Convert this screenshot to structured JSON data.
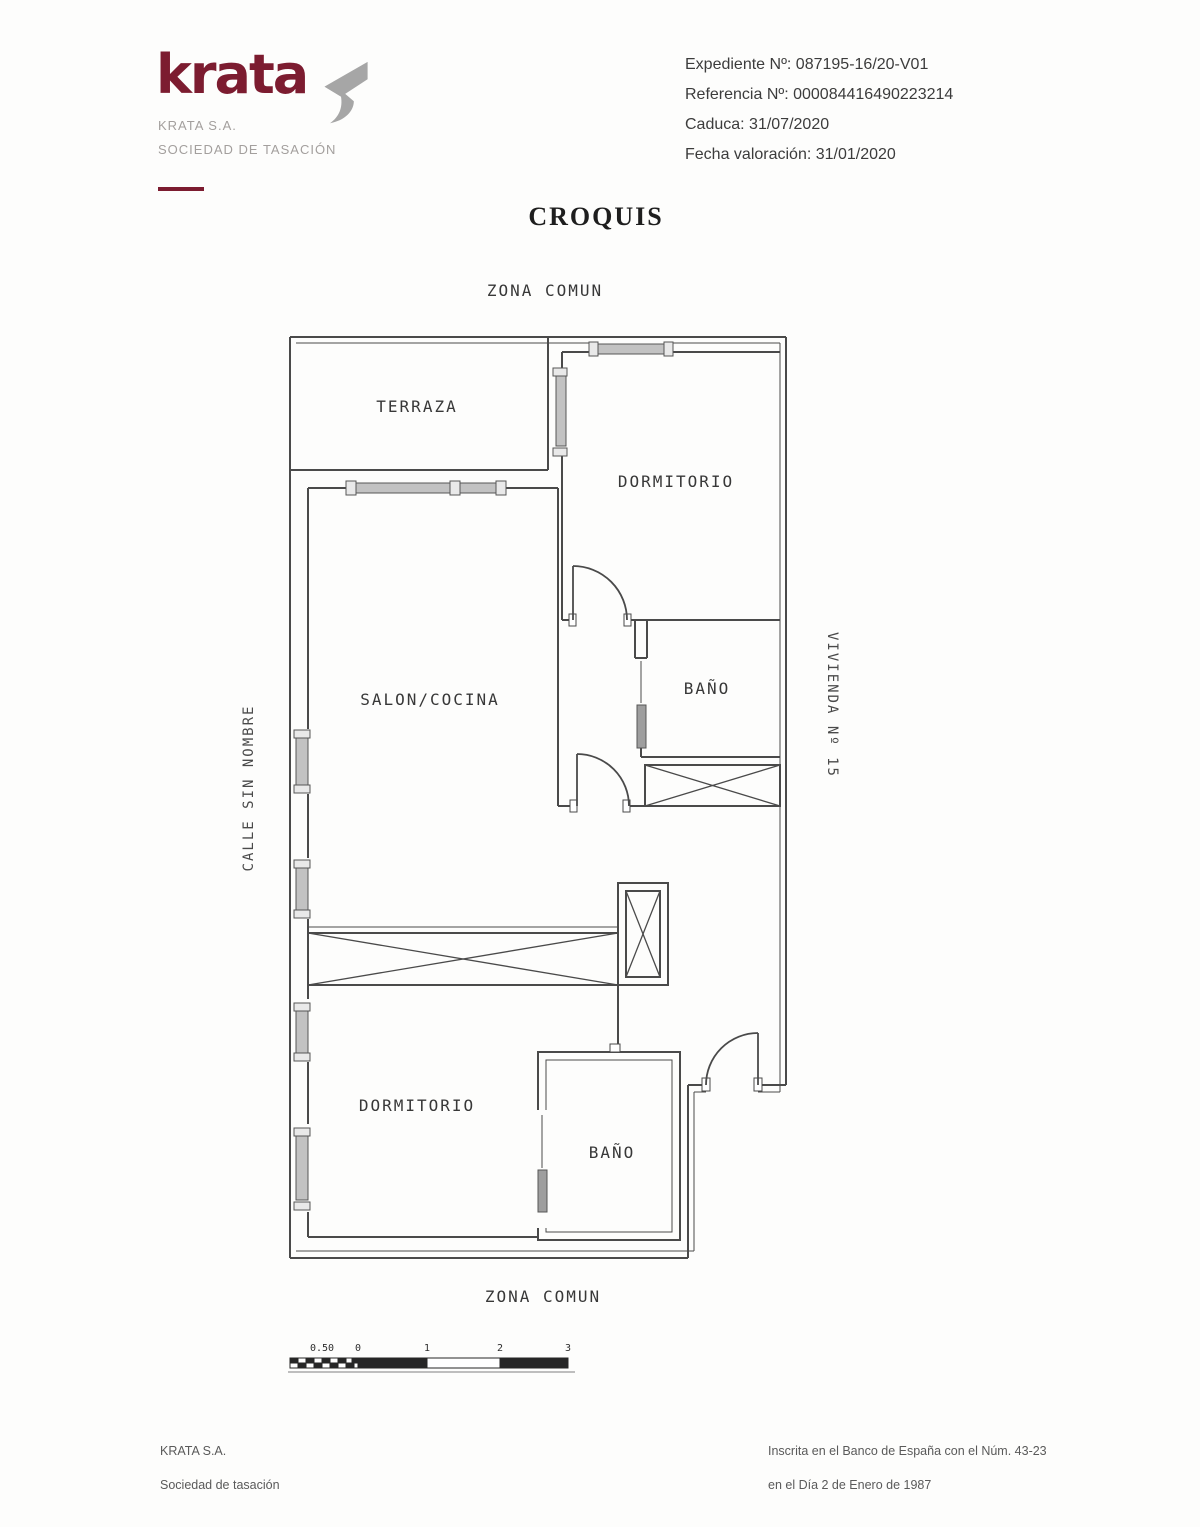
{
  "header": {
    "logo_text": "krata",
    "company_name": "KRATA S.A.",
    "company_subtitle": "SOCIEDAD DE TASACIÓN",
    "expediente": "Expediente Nº: 087195-16/20-V01",
    "referencia": "Referencia Nº: 000084416490223214",
    "caduca": "Caduca: 31/07/2020",
    "fecha_valoracion": "Fecha valoración: 31/01/2020"
  },
  "title": "CROQUIS",
  "plan": {
    "zona_comun_top": "ZONA COMUN",
    "zona_comun_bottom": "ZONA COMUN",
    "street_label": "CALLE SIN NOMBRE",
    "unit_label": "VIVIENDA Nº 15",
    "rooms": {
      "terraza": "TERRAZA",
      "dormitorio_1": "DORMITORIO",
      "salon_cocina": "SALON/COCINA",
      "bano_1": "BAÑO",
      "dormitorio_2": "DORMITORIO",
      "bano_2": "BAÑO"
    },
    "scale": {
      "labels": [
        "0.50",
        "0",
        "1",
        "2",
        "3"
      ]
    }
  },
  "footer": {
    "left_line1": "KRATA S.A.",
    "left_line2": "Sociedad de tasación",
    "right_line1": "Inscrita en el Banco de España con el Núm. 43-23",
    "right_line2": "en el Día 2 de Enero de 1987"
  },
  "colors": {
    "brand": "#7c1c30",
    "logo_mark_gray": "#a6a6a6",
    "wall_line": "#4a4a4a",
    "window_fill": "#c2c2c2"
  }
}
